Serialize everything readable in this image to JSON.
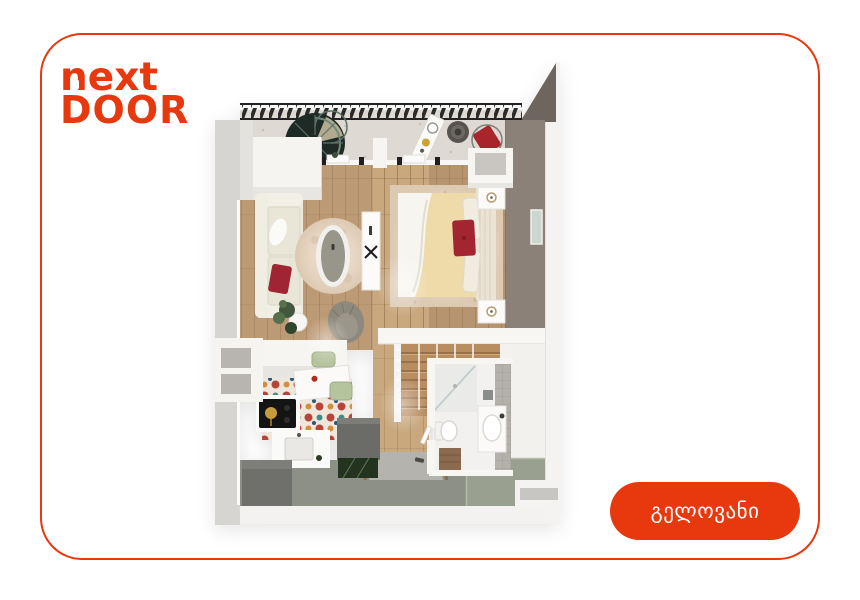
{
  "theme": {
    "accent": "#e8380d",
    "page_background": "#ffffff",
    "card_background": "#ffffff"
  },
  "brand": {
    "line1": "next",
    "line2": "DOOR"
  },
  "floor_plan": {
    "alt": "apartment-floor-plan"
  },
  "cta": {
    "label": "გელოვანი"
  }
}
